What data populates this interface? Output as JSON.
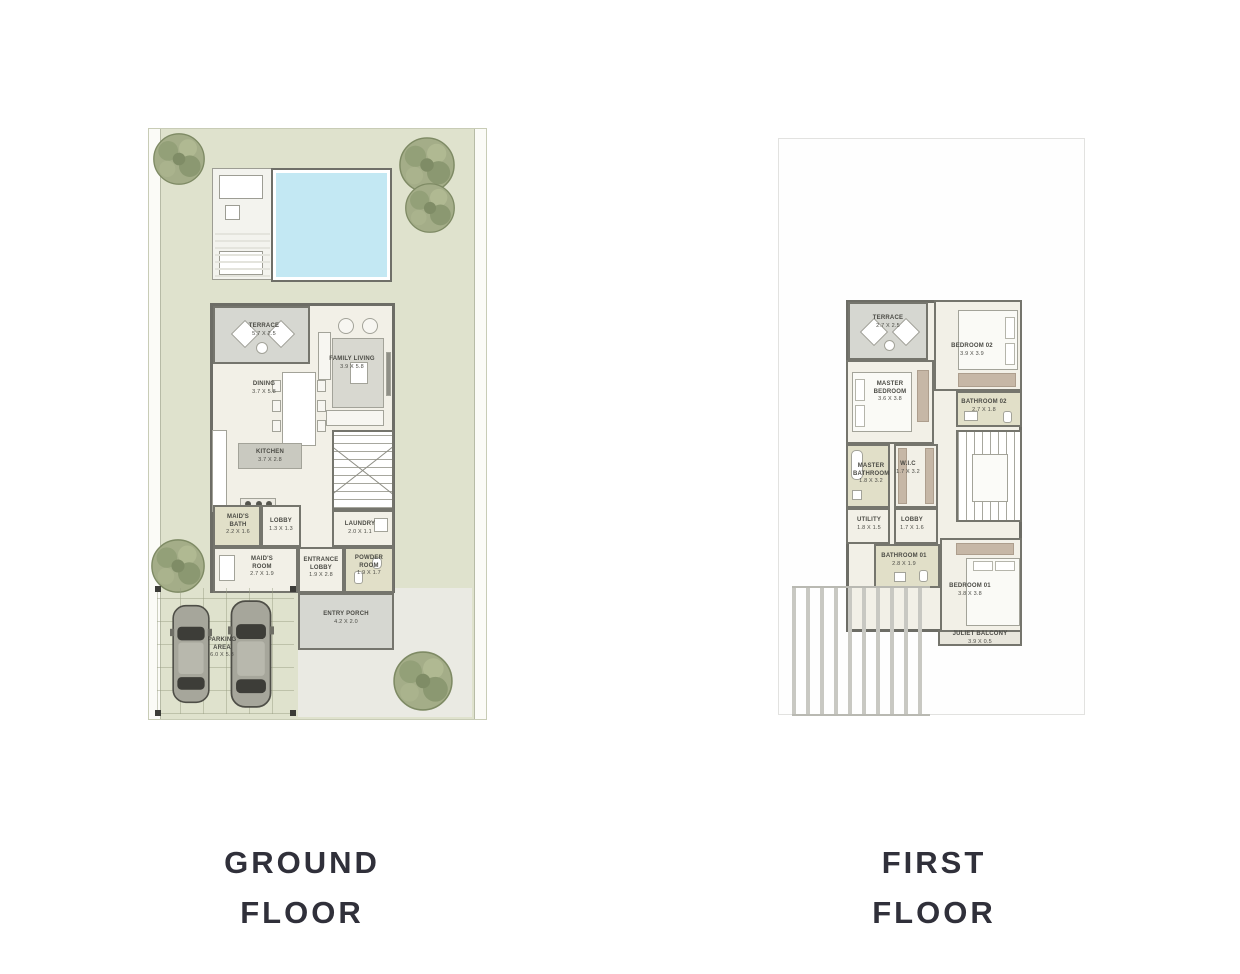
{
  "colors": {
    "garden": "#dfe2cd",
    "pool": "#c3e8f3",
    "wall": "#75756d",
    "room_floor": "#f2f0e7",
    "wet_room": "#e1dfc8",
    "terrace_gray": "#d6d7d1",
    "wardrobe_tan": "#c6b7a6",
    "title_text": "#30303a"
  },
  "ground_floor": {
    "title_line1": "GROUND",
    "title_line2": "FLOOR",
    "rooms": {
      "terrace": {
        "name": "TERRACE",
        "dims": "5.7 X 2.5"
      },
      "family_living": {
        "name": "FAMILY LIVING",
        "dims": "3.9 X 5.8"
      },
      "dining": {
        "name": "DINING",
        "dims": "3.7 X 5.8"
      },
      "kitchen": {
        "name": "KITCHEN",
        "dims": "3.7 X 2.8"
      },
      "maids_bath": {
        "name": "MAID'S BATH",
        "dims": "2.2 X 1.6"
      },
      "lobby": {
        "name": "LOBBY",
        "dims": "1.3 X 1.3"
      },
      "laundry": {
        "name": "LAUNDRY",
        "dims": "2.0 X 1.1"
      },
      "maids_room": {
        "name": "MAID'S ROOM",
        "dims": "2.7 X 1.9"
      },
      "entrance_lobby": {
        "name": "ENTRANCE LOBBY",
        "dims": "1.9 X 2.8"
      },
      "powder_room": {
        "name": "POWDER ROOM",
        "dims": "1.9 X 1.7"
      },
      "entry_porch": {
        "name": "ENTRY PORCH",
        "dims": "4.2 X 2.0"
      },
      "parking": {
        "name": "PARKING AREA",
        "dims": "6.0 X 5.8"
      }
    }
  },
  "first_floor": {
    "title_line1": "FIRST",
    "title_line2": "FLOOR",
    "rooms": {
      "terrace": {
        "name": "TERRACE",
        "dims": "2.7 X 2.5"
      },
      "master_bedroom": {
        "name": "MASTER BEDROOM",
        "dims": "3.6 X 3.8"
      },
      "bedroom_02": {
        "name": "BEDROOM 02",
        "dims": "3.9 X 3.9"
      },
      "bathroom_02": {
        "name": "BATHROOM 02",
        "dims": "2.7 X 1.8"
      },
      "master_bathroom": {
        "name": "MASTER BATHROOM",
        "dims": "1.8 X 3.2"
      },
      "wic": {
        "name": "W.I.C",
        "dims": "1.7 X 3.2"
      },
      "utility": {
        "name": "UTILITY",
        "dims": "1.8 X 1.5"
      },
      "lobby": {
        "name": "LOBBY",
        "dims": "1.7 X 1.6"
      },
      "bathroom_01": {
        "name": "BATHROOM 01",
        "dims": "2.8 X 1.9"
      },
      "bedroom_01": {
        "name": "BEDROOM 01",
        "dims": "3.8 X 3.8"
      },
      "juliet_balcony": {
        "name": "JULIET BALCONY",
        "dims": "3.9 X 0.5"
      }
    }
  }
}
